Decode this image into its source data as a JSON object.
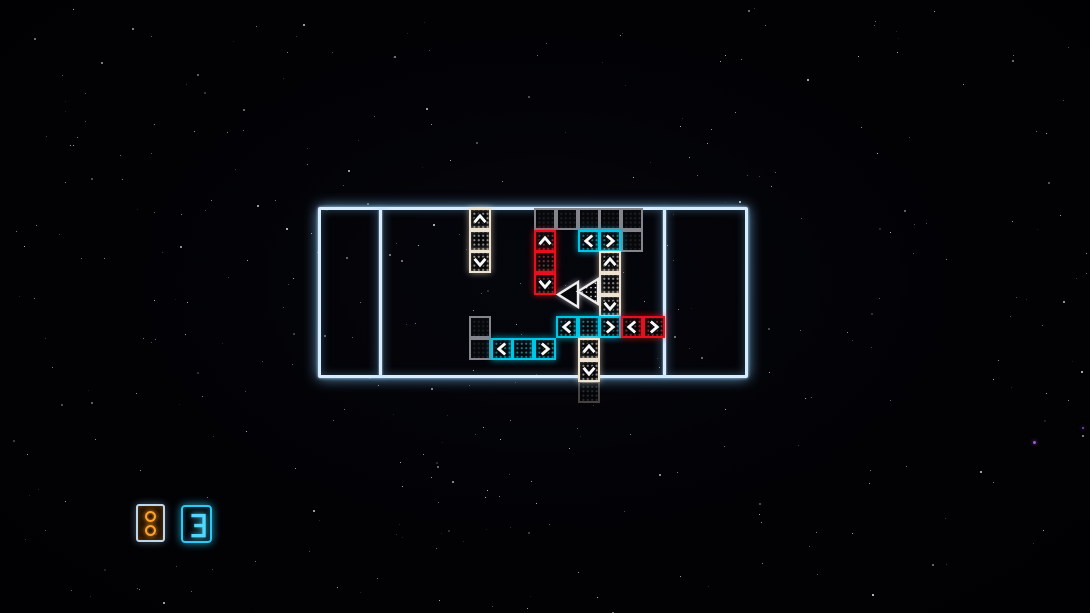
{
  "scene": {
    "width": 1090,
    "height": 613
  },
  "colors": {
    "board_line": "#d7ecff",
    "tile_gray": "#84848c",
    "tile_red": "#e6111e",
    "tile_cyan": "#00c6e6",
    "tile_white": "#eee2d0",
    "arrow_white": "#f8f8f8",
    "hud_orange": "#ffa12c",
    "hud_frame_blue": "#bdd6e8",
    "hud_cyan": "#2ec8f5",
    "star_white": "#ffffff"
  },
  "starfield": {
    "seed": 1337,
    "count": 340,
    "accent_stars": [
      {
        "x": 1033,
        "y": 441,
        "size": 3,
        "color": "#9b59d0"
      },
      {
        "x": 1082,
        "y": 427,
        "size": 2,
        "color": "#7e4fc0"
      }
    ]
  },
  "board": {
    "x": 318,
    "y": 207,
    "width": 430,
    "height": 171,
    "dividers_x": [
      380,
      664
    ],
    "grid": {
      "tile_size": 22,
      "col_x": [
        469,
        491,
        512,
        534,
        556,
        578,
        599,
        621,
        643
      ],
      "row_y": [
        208,
        230,
        251,
        273,
        295,
        316,
        338,
        360,
        381
      ]
    },
    "tiles": [
      {
        "c": 3,
        "r": 0,
        "color": "gray"
      },
      {
        "c": 4,
        "r": 0,
        "color": "gray"
      },
      {
        "c": 5,
        "r": 0,
        "color": "gray"
      },
      {
        "c": 6,
        "r": 0,
        "color": "gray"
      },
      {
        "c": 7,
        "r": 0,
        "color": "gray"
      },
      {
        "c": 7,
        "r": 1,
        "color": "gray"
      },
      {
        "c": 0,
        "r": 5,
        "color": "gray"
      },
      {
        "c": 0,
        "r": 6,
        "color": "gray"
      },
      {
        "c": 0,
        "r": 0,
        "color": "white",
        "glyph": "up"
      },
      {
        "c": 0,
        "r": 1,
        "color": "white",
        "glyph": "body"
      },
      {
        "c": 0,
        "r": 2,
        "color": "white",
        "glyph": "down"
      },
      {
        "c": 3,
        "r": 1,
        "color": "red",
        "glyph": "up"
      },
      {
        "c": 3,
        "r": 2,
        "color": "red",
        "glyph": "body"
      },
      {
        "c": 3,
        "r": 3,
        "color": "red",
        "glyph": "down"
      },
      {
        "c": 5,
        "r": 1,
        "color": "cyan",
        "glyph": "left"
      },
      {
        "c": 6,
        "r": 1,
        "color": "cyan",
        "glyph": "right"
      },
      {
        "c": 6,
        "r": 2,
        "color": "white",
        "glyph": "up"
      },
      {
        "c": 6,
        "r": 3,
        "color": "white",
        "glyph": "body"
      },
      {
        "c": 6,
        "r": 4,
        "color": "white",
        "glyph": "down"
      },
      {
        "c": 4,
        "r": 5,
        "color": "cyan",
        "glyph": "left"
      },
      {
        "c": 5,
        "r": 5,
        "color": "cyan",
        "glyph": "body"
      },
      {
        "c": 6,
        "r": 5,
        "color": "cyan",
        "glyph": "right"
      },
      {
        "c": 7,
        "r": 5,
        "color": "red",
        "glyph": "left"
      },
      {
        "c": 8,
        "r": 5,
        "color": "red",
        "glyph": "right"
      },
      {
        "c": 1,
        "r": 6,
        "color": "cyan",
        "glyph": "left"
      },
      {
        "c": 2,
        "r": 6,
        "color": "cyan",
        "glyph": "body"
      },
      {
        "c": 3,
        "r": 6,
        "color": "cyan",
        "glyph": "right"
      },
      {
        "c": 5,
        "r": 6,
        "color": "white",
        "glyph": "up"
      },
      {
        "c": 5,
        "r": 7,
        "color": "white",
        "glyph": "down"
      },
      {
        "c": 5,
        "r": 8,
        "color": "white",
        "glyph": "body",
        "dim": true
      }
    ]
  },
  "triangles": [
    {
      "style": "hollow",
      "tip_x": 558,
      "back_x": 578,
      "y_top": 282,
      "y_bottom": 307
    },
    {
      "style": "dotted",
      "tip_x": 578,
      "back_x": 598,
      "y_top": 279,
      "y_bottom": 304
    }
  ],
  "hud": {
    "tokens_tile": {
      "x": 136,
      "y": 504,
      "w": 29,
      "h": 38,
      "rings": 2
    },
    "count_tile": {
      "x": 181,
      "y": 505,
      "w": 31,
      "h": 38,
      "value": "3"
    }
  }
}
